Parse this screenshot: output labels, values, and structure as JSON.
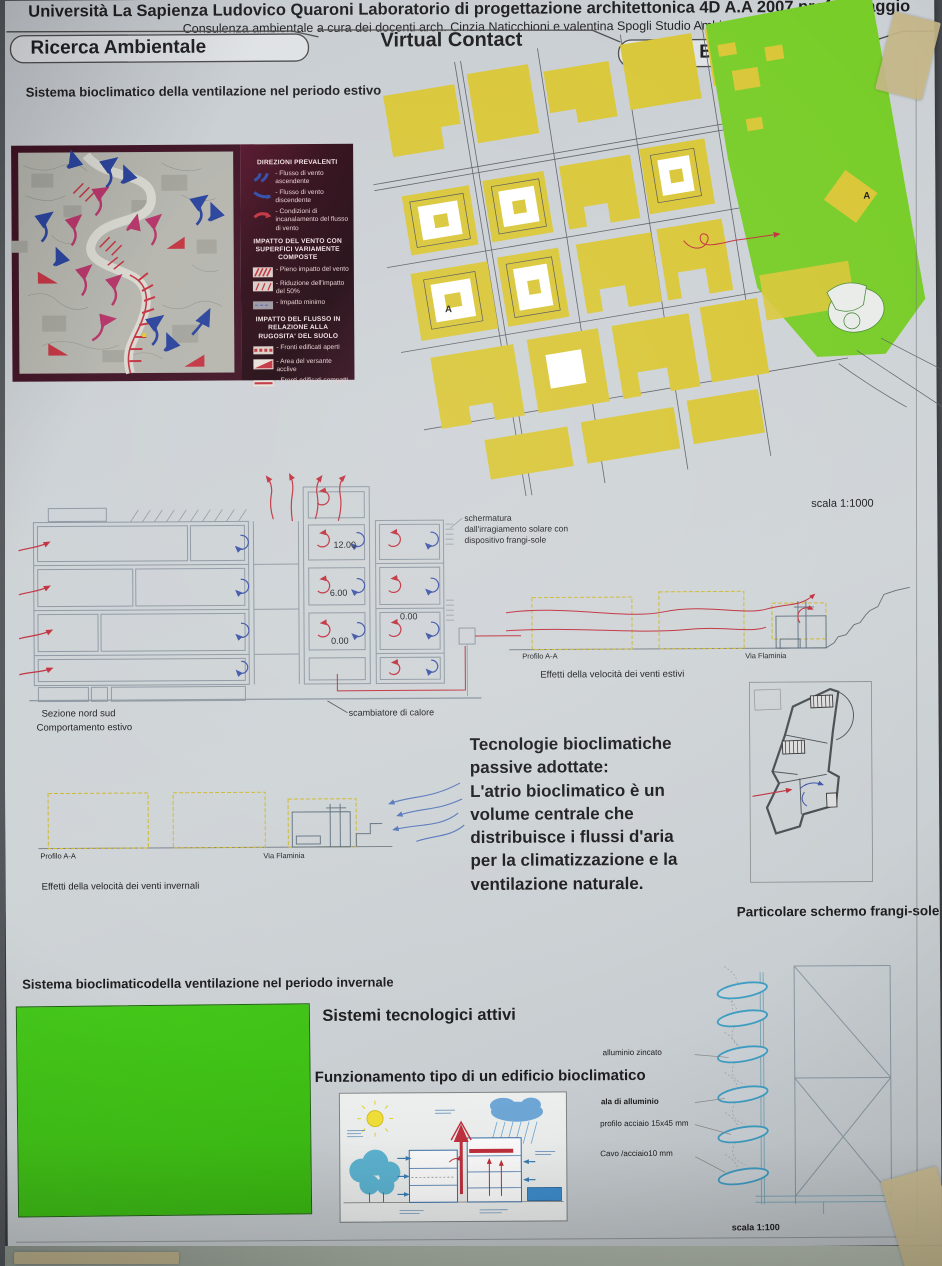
{
  "header": {
    "line1": "Università La Sapienza Ludovico Quaroni Laboratorio di progettazione  architettonica  4D A.A 2007  prof.  A.Saggio",
    "line2": "Consulenza ambientale a cura dei docenti arch. Cinzia Naticchioni e valentina Spogli Studio Ambientale"
  },
  "banner": {
    "left": "Ricerca Ambientale",
    "center": "Virtual Contact",
    "right": "stud. Bellardini Fabiola"
  },
  "summer": {
    "title": "Sistema bioclimatico della ventilazione nel periodo estivo",
    "scale": "scala 1:1000"
  },
  "legend": {
    "title1": "DIREZIONI PREVALENTI",
    "items1": [
      "- Flusso di vento ascendente",
      "- Flusso di vento discendente",
      "- Condizioni di incanalamento del flusso di vento"
    ],
    "title2": "IMPATTO DEL VENTO CON SUPERFICI VARIAMENTE COMPOSTE",
    "items2": [
      "- Pieno impatto del vento",
      "- Riduzione dell'impatto del 50%",
      "- Impatto minimo"
    ],
    "title3": "IMPATTO DEL FLUSSO IN RELAZIONE ALLA RUGOSITA' DEL SUOLO",
    "items3": [
      "- Fronti edificati aperti",
      "- Area del versante acclive",
      "- Fronti edificati compatti"
    ]
  },
  "siteplan": {
    "marker_a": "A"
  },
  "section": {
    "levels": [
      "12.00",
      "6.00",
      "0.00",
      "0.00"
    ],
    "schermatura": "schermatura\ndall'irragiamento solare con\ndispositivo frangi-sole",
    "sezione": "Sezione nord  sud",
    "comportamento": "Comportamento estivo",
    "scambiatore": "scambiatore di calore"
  },
  "profiles": {
    "summer": {
      "profilo": "Profilo  A-A",
      "via": "Via Flaminia",
      "caption": "Effetti della velocità dei venti estivi"
    },
    "winter": {
      "profilo": "Profilo  A-A",
      "via": "Via Flaminia",
      "caption": "Effetti della velocità dei venti invernali"
    }
  },
  "passive": {
    "text": "Tecnologie bioclimatiche\npassive adottate:\nL'atrio bioclimatico è un\nvolume centrale che\ndistribuisce i flussi d'aria\nper la climatizzazione e la\nventilazione naturale."
  },
  "particolare": {
    "caption": "Particolare  schermo frangi-sole"
  },
  "winter": {
    "title": "Sistema bioclimaticodella ventilazione nel periodo invernale"
  },
  "active": {
    "title": "Sistemi tecnologici attivi",
    "subtitle": "Funzionamento  tipo di un edificio bioclimatico"
  },
  "detail": {
    "labels": [
      "alluminio zincato",
      "ala di alluminio",
      "profilo acciaio 15x45 mm",
      "Cavo /acciaio10 mm"
    ],
    "scale": "scala 1:100"
  },
  "colors": {
    "arrow_red": "#c1303d",
    "arrow_blue": "#2e4aa5",
    "block_yellow": "#d9c636",
    "park_green": "#78cd28",
    "panel_green": "#3ec214",
    "legend_bg": "#2e0916"
  }
}
